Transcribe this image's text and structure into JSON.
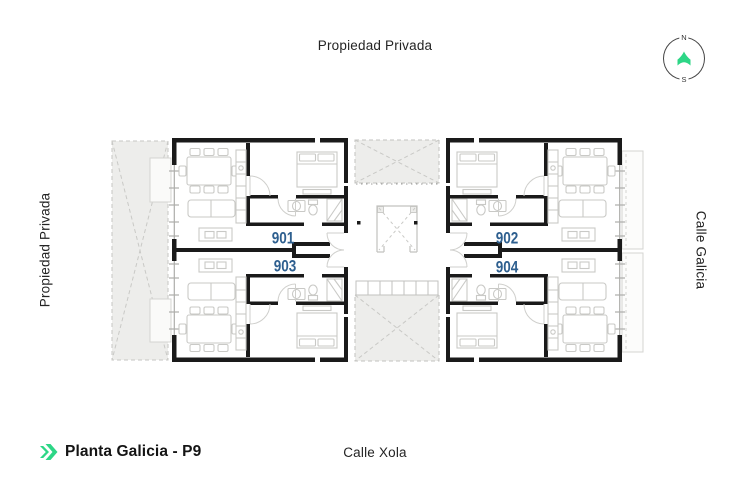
{
  "colors": {
    "accent_green": "#2dd686",
    "unit_blue": "#2e5f8f",
    "wall": "#1a1a1a"
  },
  "labels": {
    "top": "Propiedad Privada",
    "left": "Propiedad Privada",
    "right": "Calle Galicia",
    "bottom": "Calle Xola"
  },
  "compass": {
    "north": "N",
    "south": "S"
  },
  "footer": {
    "title": "Planta Galicia - P9"
  },
  "units": [
    {
      "id": "901"
    },
    {
      "id": "902"
    },
    {
      "id": "903"
    },
    {
      "id": "904"
    }
  ]
}
